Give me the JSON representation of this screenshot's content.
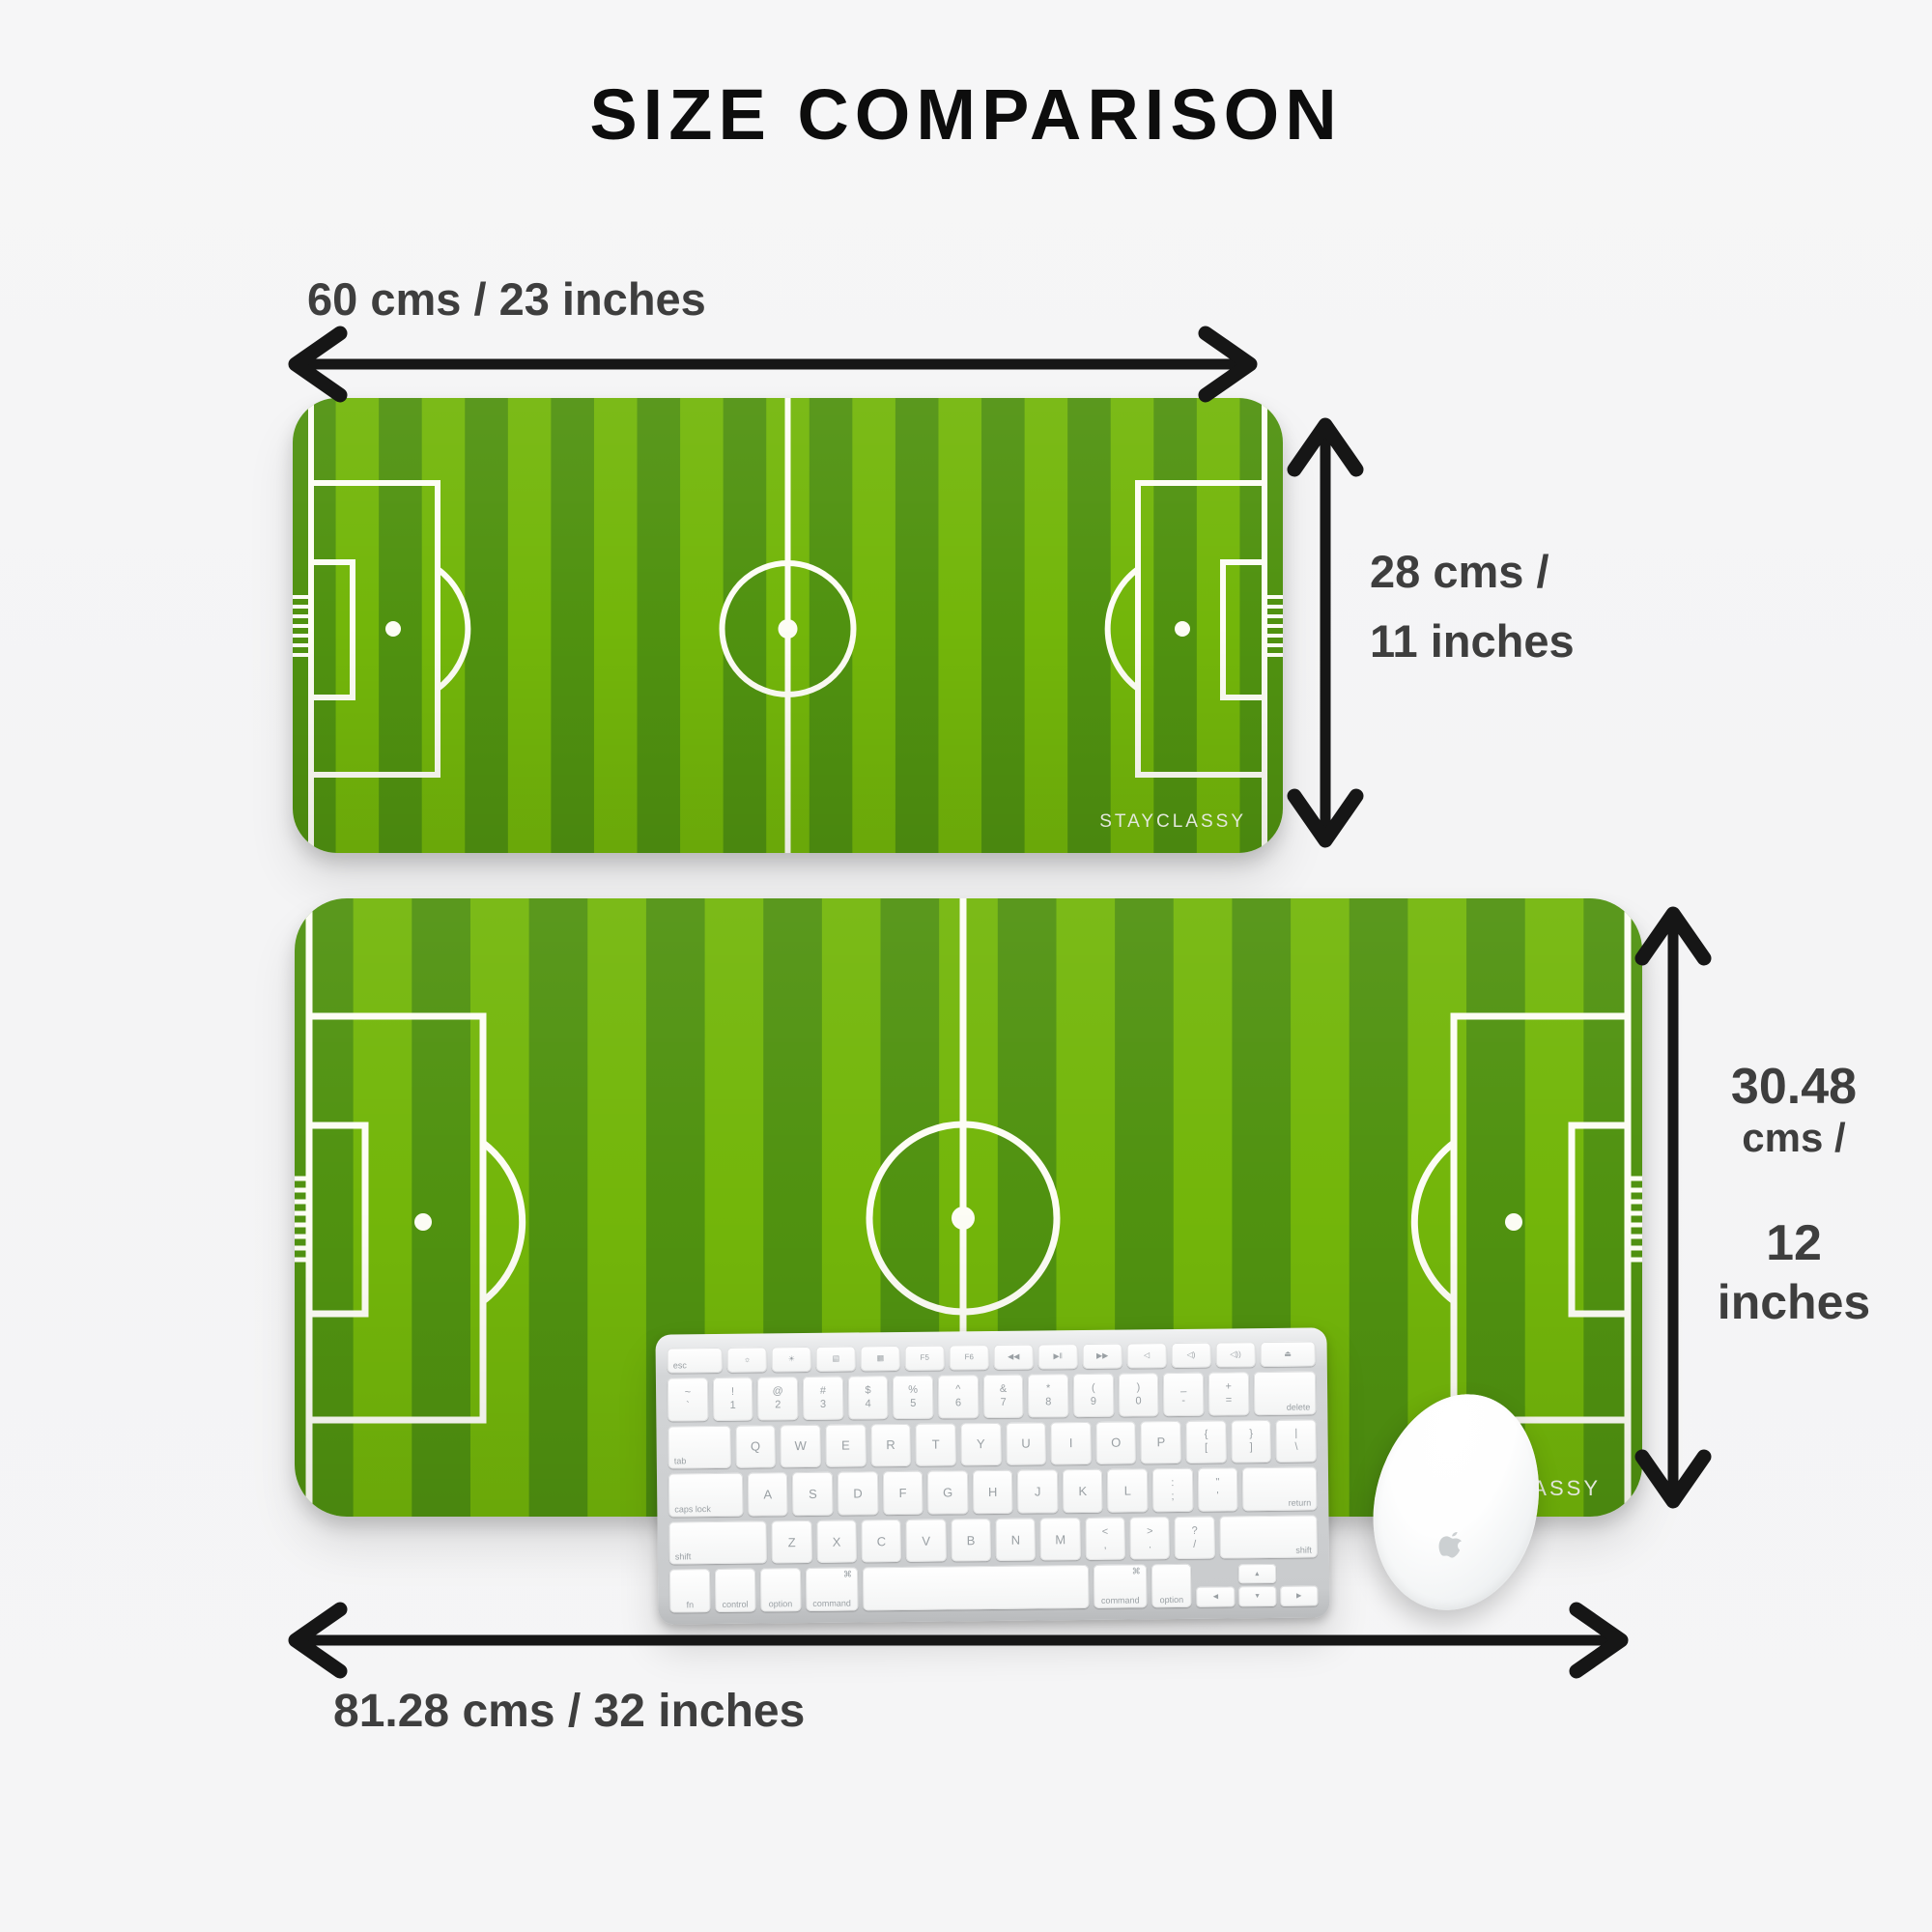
{
  "title": "SIZE COMPARISON",
  "colors": {
    "background": "#f4f4f5",
    "stripe_light": "#73b60a",
    "stripe_dark": "#509210",
    "field_line": "#fdfdf5",
    "arrow": "#161616",
    "label_text": "#3e3e3e"
  },
  "mats": {
    "small": {
      "brand": "STAYCLASSY",
      "width_label": "60 cms / 23 inches",
      "height_label": [
        "28 cms /",
        "11 inches"
      ]
    },
    "large": {
      "brand": "STAYCLASSY",
      "width_label": "81.28 cms / 32 inches",
      "height_label": [
        "30.48",
        "cms /",
        "12",
        "inches"
      ]
    }
  },
  "keyboard": {
    "arrows": [
      "◀",
      "▲",
      "▼",
      "▶"
    ],
    "rows": [
      {
        "fn": true,
        "keys": [
          {
            "sub": "esc",
            "align": "bl",
            "w": 1.4
          },
          {
            "glyph": "☼"
          },
          {
            "glyph": "☀"
          },
          {
            "glyph": "▤"
          },
          {
            "glyph": "▦"
          },
          {
            "glyph": "F5"
          },
          {
            "glyph": "F6"
          },
          {
            "glyph": "◀◀"
          },
          {
            "glyph": "▶‖"
          },
          {
            "glyph": "▶▶"
          },
          {
            "glyph": "◁"
          },
          {
            "glyph": "◁)"
          },
          {
            "glyph": "◁))"
          },
          {
            "glyph": "⏏",
            "w": 1.4
          }
        ]
      },
      {
        "keys": [
          {
            "top": "~",
            "bot": "`"
          },
          {
            "top": "!",
            "bot": "1"
          },
          {
            "top": "@",
            "bot": "2"
          },
          {
            "top": "#",
            "bot": "3"
          },
          {
            "top": "$",
            "bot": "4"
          },
          {
            "top": "%",
            "bot": "5"
          },
          {
            "top": "^",
            "bot": "6"
          },
          {
            "top": "&",
            "bot": "7"
          },
          {
            "top": "*",
            "bot": "8"
          },
          {
            "top": "(",
            "bot": "9"
          },
          {
            "top": ")",
            "bot": "0"
          },
          {
            "top": "_",
            "bot": "-"
          },
          {
            "top": "+",
            "bot": "="
          },
          {
            "sub": "delete",
            "align": "br",
            "w": 1.55
          }
        ]
      },
      {
        "keys": [
          {
            "sub": "tab",
            "align": "bl",
            "w": 1.55
          },
          {
            "cap": "Q"
          },
          {
            "cap": "W"
          },
          {
            "cap": "E"
          },
          {
            "cap": "R"
          },
          {
            "cap": "T"
          },
          {
            "cap": "Y"
          },
          {
            "cap": "U"
          },
          {
            "cap": "I"
          },
          {
            "cap": "O"
          },
          {
            "cap": "P"
          },
          {
            "top": "{",
            "bot": "["
          },
          {
            "top": "}",
            "bot": "]"
          },
          {
            "top": "|",
            "bot": "\\"
          }
        ]
      },
      {
        "keys": [
          {
            "sub": "caps lock",
            "align": "bl",
            "w": 1.85
          },
          {
            "cap": "A"
          },
          {
            "cap": "S"
          },
          {
            "cap": "D"
          },
          {
            "cap": "F"
          },
          {
            "cap": "G"
          },
          {
            "cap": "H"
          },
          {
            "cap": "J"
          },
          {
            "cap": "K"
          },
          {
            "cap": "L"
          },
          {
            "top": ":",
            "bot": ";"
          },
          {
            "top": "\"",
            "bot": "'"
          },
          {
            "sub": "return",
            "align": "br",
            "w": 1.85
          }
        ]
      },
      {
        "keys": [
          {
            "sub": "shift",
            "align": "bl",
            "w": 2.45
          },
          {
            "cap": "Z"
          },
          {
            "cap": "X"
          },
          {
            "cap": "C"
          },
          {
            "cap": "V"
          },
          {
            "cap": "B"
          },
          {
            "cap": "N"
          },
          {
            "cap": "M"
          },
          {
            "top": "<",
            "bot": ","
          },
          {
            "top": ">",
            "bot": "."
          },
          {
            "top": "?",
            "bot": "/"
          },
          {
            "sub": "shift",
            "align": "br",
            "w": 2.45
          }
        ]
      },
      {
        "keys": [
          {
            "sub": "fn",
            "align": "bc"
          },
          {
            "sub": "control",
            "align": "bc"
          },
          {
            "sub": "option",
            "align": "bc"
          },
          {
            "sub": "command",
            "align": "bc",
            "glyph": "⌘",
            "w": 1.3
          },
          {
            "space": true,
            "w": 5.6
          },
          {
            "sub": "command",
            "align": "bc",
            "glyph": "⌘",
            "w": 1.3
          },
          {
            "sub": "option",
            "align": "bc"
          },
          {
            "arrows": true,
            "w": 3
          }
        ]
      }
    ]
  }
}
